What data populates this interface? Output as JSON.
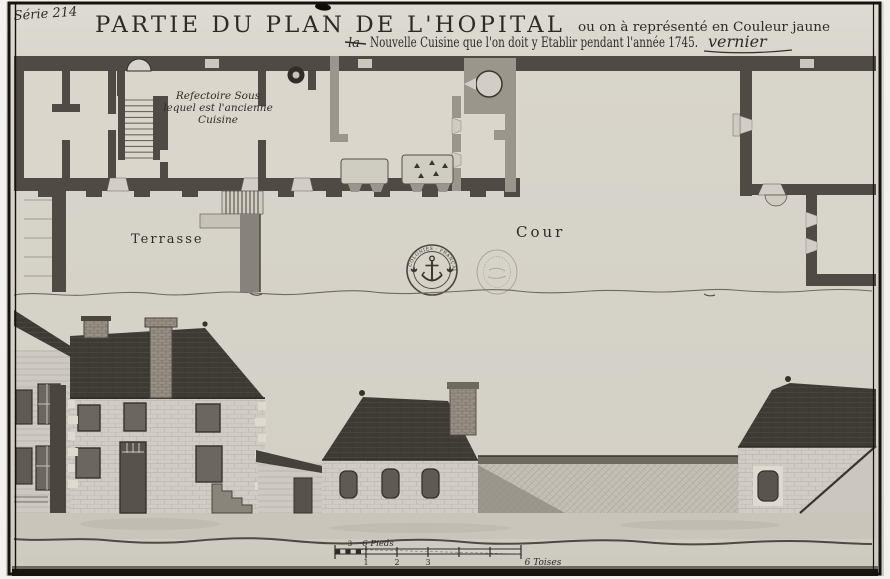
{
  "meta": {
    "archive_note": "Série 214"
  },
  "title": {
    "main": "PARTIE DU PLAN DE L'HOPITAL",
    "tail": "ou on à représenté en Couleur jaune",
    "struck_word": "la",
    "line2": "Nouvelle Cuisine que l'on doit y Etablir pendant l'année 1745.",
    "signature": "vernier"
  },
  "plan_labels": {
    "refectory_line1": "Refectoire Sous",
    "refectory_line2": "lequel est l'ancienne",
    "refectory_line3": "Cuisine",
    "terrace": "Terrasse",
    "courtyard": "Cour"
  },
  "stamps": {
    "left_text": "· COLONIES · FRANÇAISES ·"
  },
  "scale_bar": {
    "pieds_mid": "3",
    "pieds_label": "6 Pieds",
    "ticks": [
      "1",
      "2",
      "3"
    ],
    "toises_label": "6 Toises"
  },
  "colors": {
    "paper": "#d7d4ca",
    "wall_dark": "#4f4b44",
    "wall_new": "#9b968b",
    "roof_dark": "#3e3b34",
    "ink": "#2e2b26"
  }
}
